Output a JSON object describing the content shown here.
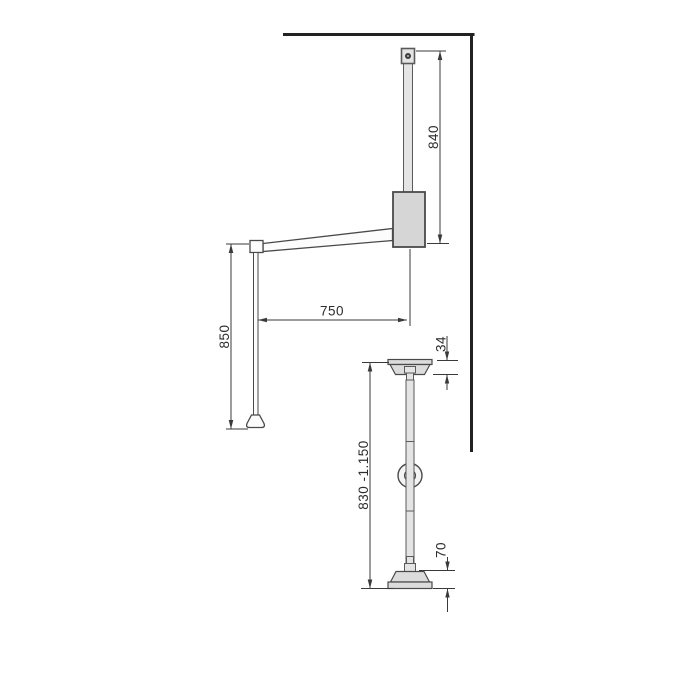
{
  "drawing": {
    "kind": "technical-dimension-diagram",
    "views": {
      "side_view": "wall-mounted lift arm (side view)",
      "front_view": "hanging pole with mounting plates (front view)"
    },
    "labels": {
      "arm_height": "840",
      "arm_reach": "750",
      "pull_rod_length": "850",
      "top_plate_height": "34",
      "pole_range": "830 -1.150",
      "bottom_plate_height": "70"
    },
    "colors": {
      "wall_line": "#222222",
      "dimension_line": "#3a3a3a",
      "text": "#2d2d2d",
      "part_fill_light": "#e4e4e4",
      "part_fill_mid": "#d6d6d6",
      "plate_fill": "#dcdcdc",
      "background": "#ffffff"
    }
  }
}
